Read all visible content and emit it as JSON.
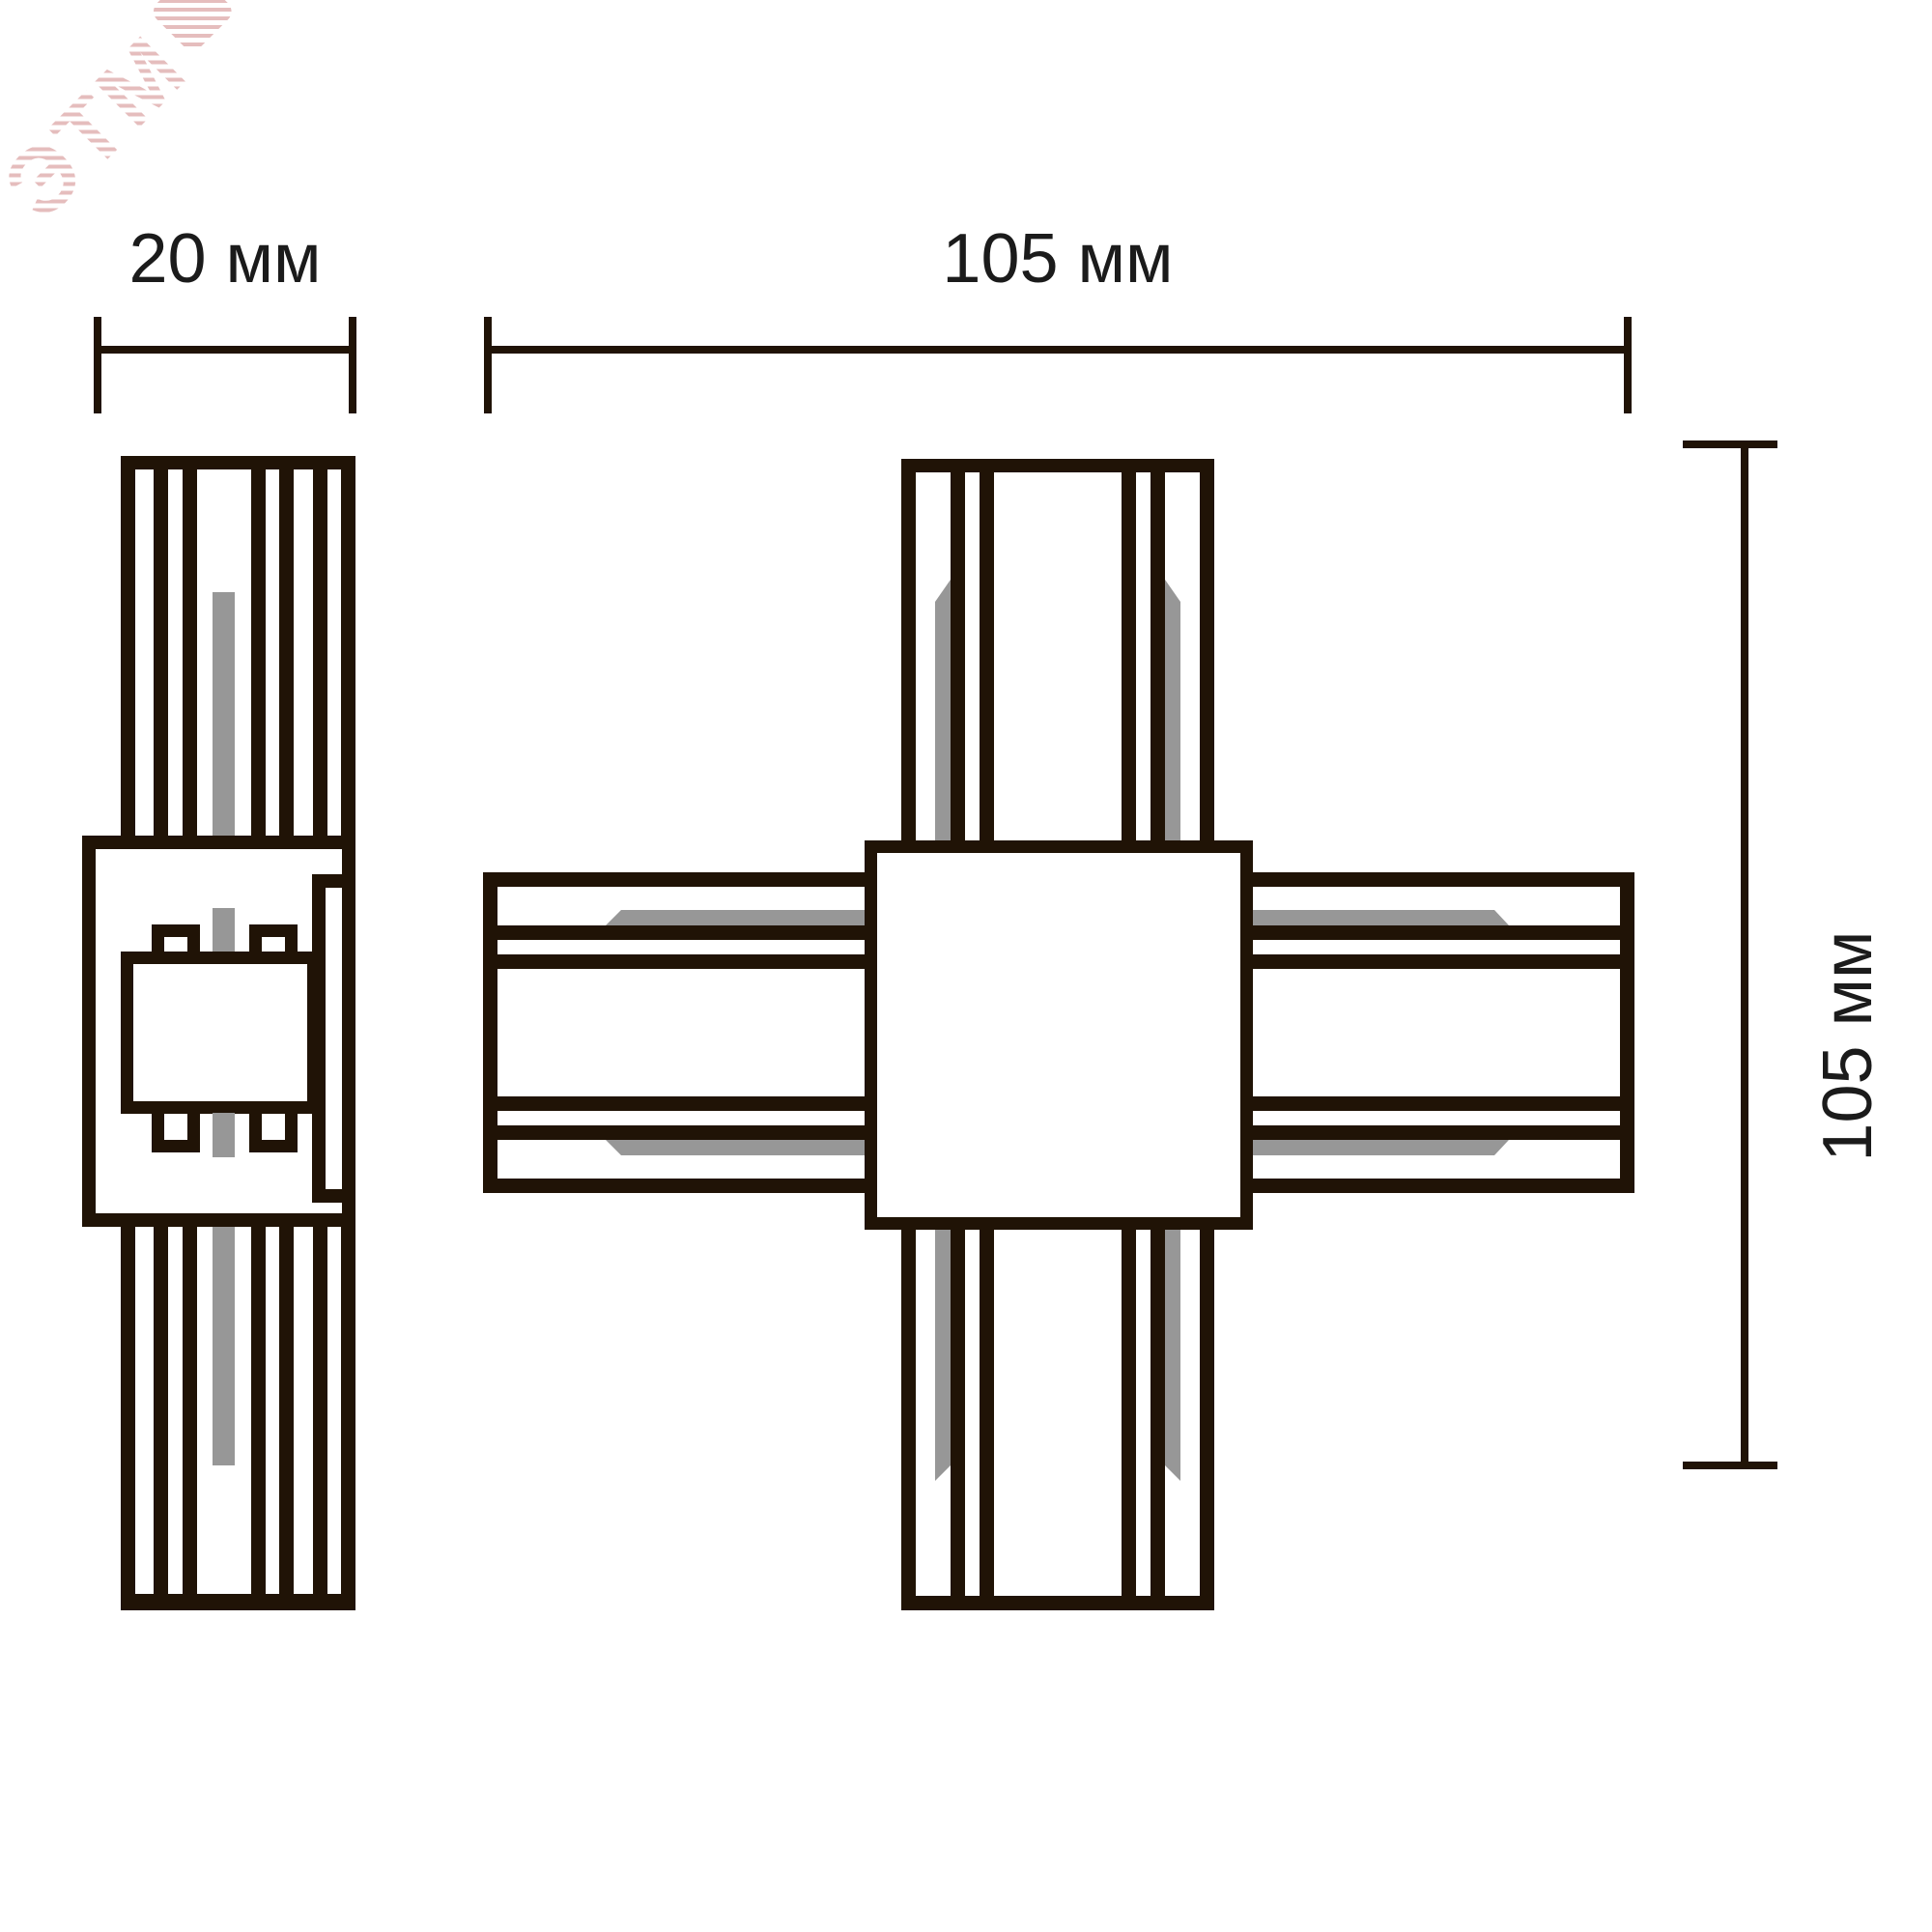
{
  "title": "X-connector track dimensions drawing",
  "watermark": "ЭТМ",
  "labels": {
    "side_width": "20 мм",
    "front_width": "105 мм",
    "front_height": "105 мм"
  },
  "colors": {
    "line": "#201306",
    "conductor_gray": "#979797",
    "text": "#1b1b1b",
    "watermark": "#cd7d7d",
    "background": "#ffffff"
  }
}
